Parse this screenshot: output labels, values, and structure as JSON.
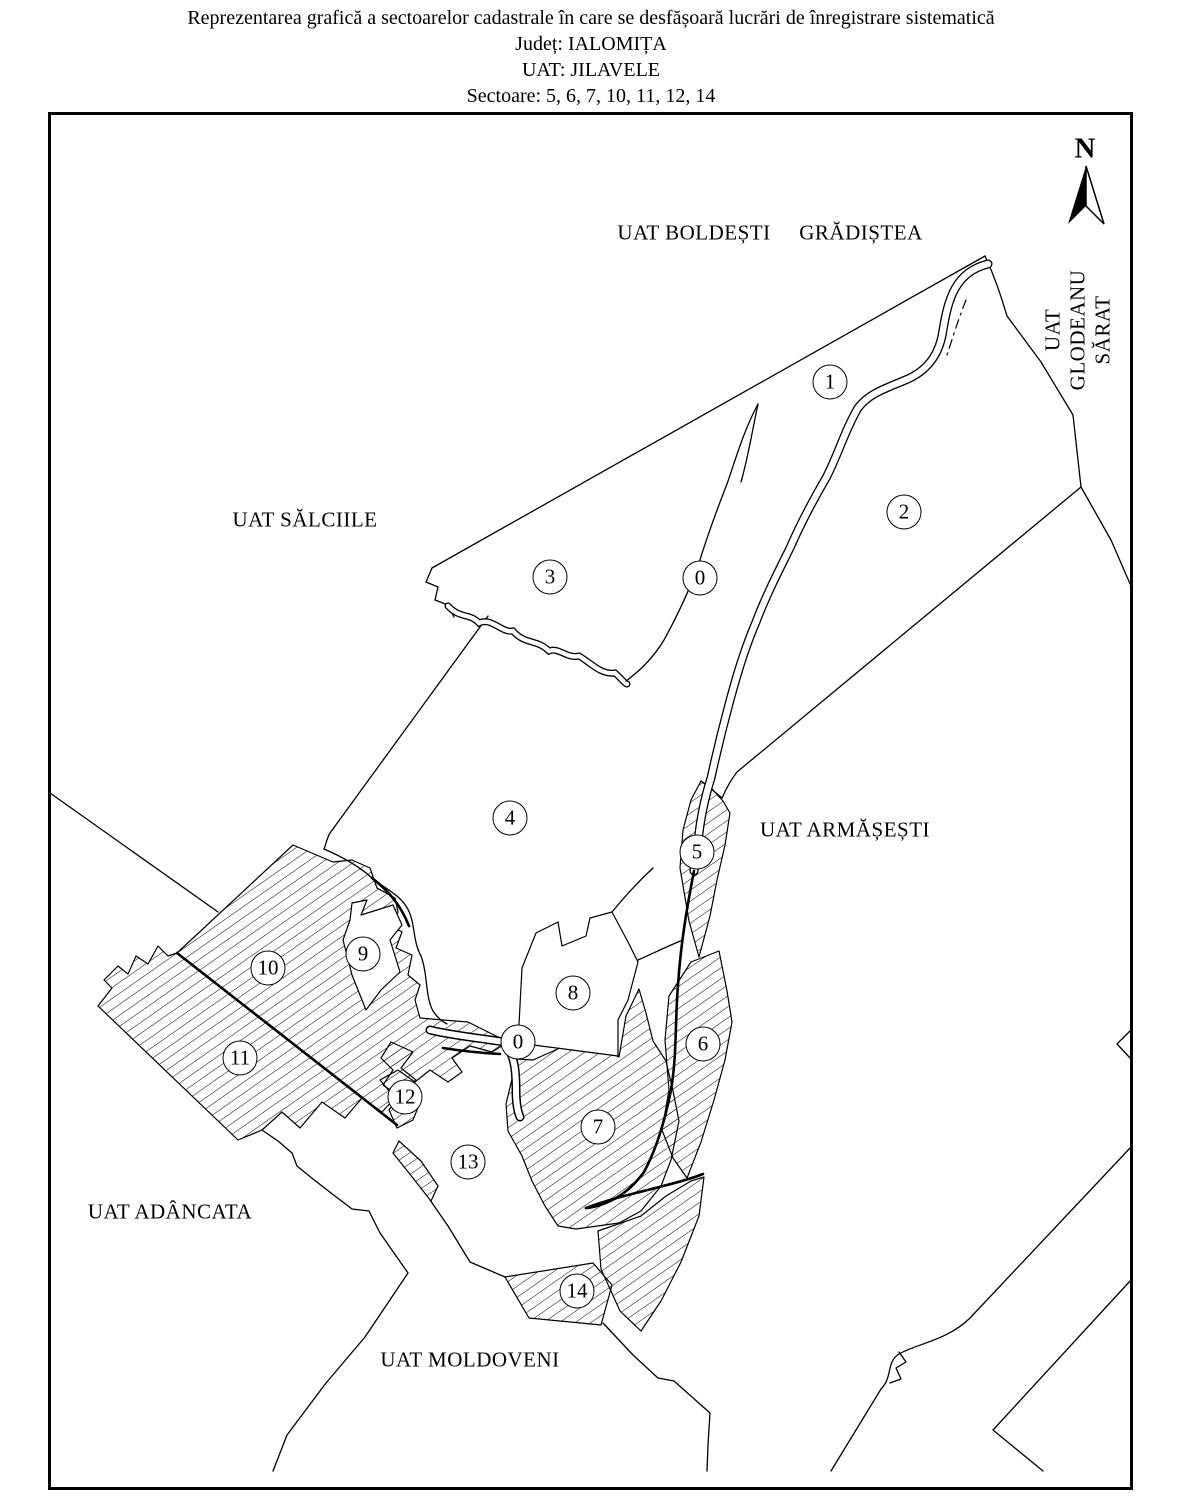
{
  "title": {
    "line1": "Reprezentarea grafică a sectoarelor cadastrale în care se desfășoară lucrări de înregistrare sistematică",
    "line2": "Județ: IALOMIȚA",
    "line3": "UAT: JILAVELE",
    "line4": "Sectoare: 5, 6, 7, 10, 11, 12, 14"
  },
  "map": {
    "compass_label": "N",
    "hatched_sector_numbers": [
      "5",
      "6",
      "7",
      "10",
      "11",
      "12",
      "14"
    ],
    "colors": {
      "ink": "#000000",
      "paper": "#ffffff"
    },
    "sectors": [
      {
        "num": "1",
        "x": 830,
        "y": 382
      },
      {
        "num": "2",
        "x": 904,
        "y": 512
      },
      {
        "num": "3",
        "x": 550,
        "y": 577
      },
      {
        "num": "0",
        "x": 700,
        "y": 578
      },
      {
        "num": "4",
        "x": 510,
        "y": 818
      },
      {
        "num": "5",
        "x": 697,
        "y": 852
      },
      {
        "num": "9",
        "x": 363,
        "y": 954
      },
      {
        "num": "10",
        "x": 268,
        "y": 968
      },
      {
        "num": "8",
        "x": 573,
        "y": 993
      },
      {
        "num": "0",
        "x": 518,
        "y": 1042
      },
      {
        "num": "6",
        "x": 703,
        "y": 1044
      },
      {
        "num": "11",
        "x": 240,
        "y": 1058
      },
      {
        "num": "12",
        "x": 405,
        "y": 1097
      },
      {
        "num": "7",
        "x": 598,
        "y": 1127
      },
      {
        "num": "13",
        "x": 468,
        "y": 1162
      },
      {
        "num": "14",
        "x": 577,
        "y": 1291
      }
    ],
    "neighbors": [
      {
        "label": "UAT BOLDEȘTI",
        "x": 694,
        "y": 233,
        "rotate": 0
      },
      {
        "label": "GRĂDIȘTEA",
        "x": 861,
        "y": 233,
        "rotate": 0
      },
      {
        "label": "UAT\nGLODEANU\nSĂRAT",
        "x": 1078,
        "y": 330,
        "rotate": -90
      },
      {
        "label": "UAT SĂLCIILE",
        "x": 305,
        "y": 520,
        "rotate": 0
      },
      {
        "label": "UAT ARMĂȘEȘTI",
        "x": 845,
        "y": 830,
        "rotate": 0
      },
      {
        "label": "UAT ADÂNCATA",
        "x": 170,
        "y": 1212,
        "rotate": 0
      },
      {
        "label": "UAT MOLDOVENI",
        "x": 470,
        "y": 1360,
        "rotate": 0
      }
    ]
  }
}
